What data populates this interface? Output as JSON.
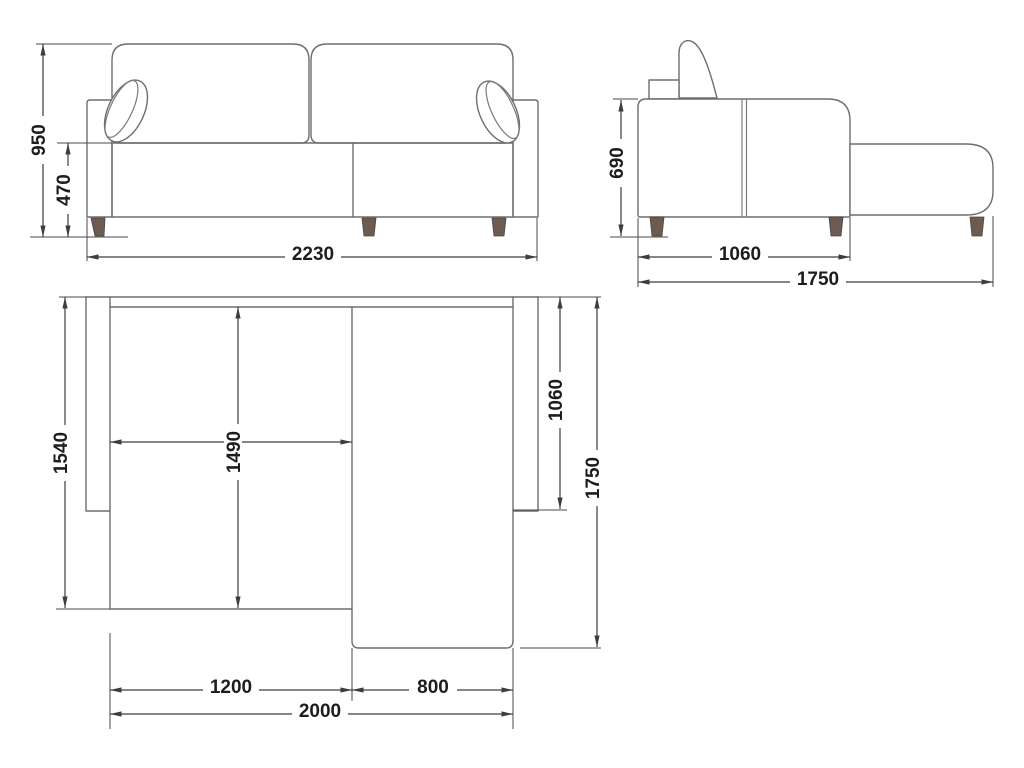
{
  "drawing": {
    "subject": "corner-sofa-with-chaise-technical-drawing",
    "views": [
      "front-elevation",
      "side-elevation",
      "plan"
    ]
  },
  "dims": {
    "front_total_height": "950",
    "front_seat_height": "470",
    "front_total_width": "2230",
    "side_seat_height": "690",
    "side_body_depth": "1060",
    "side_total_depth": "1750",
    "top_back_depth": "1540",
    "top_inner_depth": "1490",
    "top_right_depth": "1060",
    "top_total_depth": "1750",
    "top_left_width": "1200",
    "top_chaise_width": "800",
    "top_total_width": "2000"
  },
  "colors": {
    "background": "#ffffff",
    "furniture_line": "#6e6e6e",
    "dimension_line": "#3d3d3d",
    "text": "#1d1d1d",
    "leg": "#6b5b51"
  }
}
